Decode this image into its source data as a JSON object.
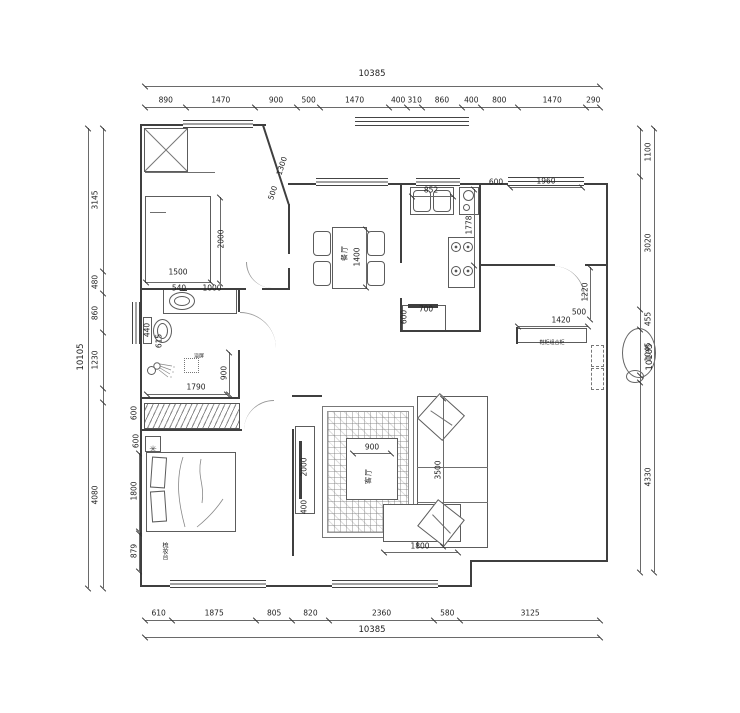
{
  "colors": {
    "wall": "#3f3f3f",
    "line": "#6a6a6a",
    "text": "#222222",
    "bg": "#ffffff"
  },
  "dims": {
    "top": {
      "total": "10385",
      "segments": [
        {
          "label": "890",
          "mm": 890
        },
        {
          "label": "1470",
          "mm": 1470
        },
        {
          "label": "900",
          "mm": 900
        },
        {
          "label": "500",
          "mm": 500
        },
        {
          "label": "1470",
          "mm": 1470
        },
        {
          "label": "400",
          "mm": 400
        },
        {
          "label": "310",
          "mm": 310
        },
        {
          "label": "860",
          "mm": 860
        },
        {
          "label": "400",
          "mm": 400
        },
        {
          "label": "800",
          "mm": 800
        },
        {
          "label": "1470",
          "mm": 1470
        },
        {
          "label": "290",
          "mm": 290
        }
      ]
    },
    "bottom": {
      "total": "10385",
      "segments": [
        {
          "label": "610",
          "mm": 610
        },
        {
          "label": "1875",
          "mm": 1875
        },
        {
          "label": "805",
          "mm": 805
        },
        {
          "label": "820",
          "mm": 820
        },
        {
          "label": "2360",
          "mm": 2360
        },
        {
          "label": "580",
          "mm": 580
        },
        {
          "label": "3125",
          "mm": 3125
        }
      ]
    },
    "left": {
      "total": "10105",
      "segments": [
        {
          "label": "3145",
          "mm": 3145
        },
        {
          "label": "480",
          "mm": 480
        },
        {
          "label": "860",
          "mm": 860
        },
        {
          "label": "1230",
          "mm": 1230
        },
        {
          "label": "",
          "mm": 310
        },
        {
          "label": "4080",
          "mm": 4080
        }
      ]
    },
    "right": {
      "total": "10105",
      "segments": [
        {
          "label": "1100",
          "mm": 1100
        },
        {
          "label": "3020",
          "mm": 3020
        },
        {
          "label": "455",
          "mm": 455
        },
        {
          "label": "1045",
          "mm": 1045
        },
        {
          "label": "",
          "mm": 155
        },
        {
          "label": "4330",
          "mm": 4330
        }
      ]
    }
  },
  "labels": {
    "dining": "餐厅",
    "living": "客厅",
    "shower_screen": "浴屏",
    "dresser": "梳妆台",
    "cabinet_note": "鞋柜组合柜"
  },
  "icons": {
    "planter": "✳"
  },
  "interior_dims": [
    {
      "label": "2000",
      "x": 221,
      "y": 239,
      "rot": -90,
      "line": {
        "x": 220,
        "y": 197,
        "w": 1,
        "h": 86
      }
    },
    {
      "label": "1500",
      "x": 178,
      "y": 272,
      "rot": 0,
      "line": {
        "x": 146,
        "y": 282,
        "w": 65,
        "h": 1
      }
    },
    {
      "label": "540",
      "x": 179,
      "y": 288,
      "rot": 0
    },
    {
      "label": "1000",
      "x": 212,
      "y": 288,
      "rot": 0
    },
    {
      "label": "1300",
      "x": 282,
      "y": 166,
      "rot": -72
    },
    {
      "label": "500",
      "x": 273,
      "y": 193,
      "rot": -72
    },
    {
      "label": "440",
      "x": 147,
      "y": 330,
      "rot": -90
    },
    {
      "label": "615",
      "x": 159,
      "y": 341,
      "rot": -90
    },
    {
      "label": "900",
      "x": 224,
      "y": 373,
      "rot": -90,
      "line": {
        "x": 229,
        "y": 352,
        "w": 1,
        "h": 42
      }
    },
    {
      "label": "1790",
      "x": 196,
      "y": 387,
      "rot": 0,
      "line": {
        "x": 147,
        "y": 394,
        "w": 80,
        "h": 1
      }
    },
    {
      "label": "600",
      "x": 134,
      "y": 413,
      "rot": -90
    },
    {
      "label": "600",
      "x": 136,
      "y": 441,
      "rot": -90
    },
    {
      "label": "1800",
      "x": 134,
      "y": 491,
      "rot": -90,
      "line": {
        "x": 139,
        "y": 453,
        "w": 1,
        "h": 78
      }
    },
    {
      "label": "879",
      "x": 134,
      "y": 551,
      "rot": -90,
      "line": {
        "x": 139,
        "y": 533,
        "w": 1,
        "h": 38
      }
    },
    {
      "label": "1400",
      "x": 357,
      "y": 257,
      "rot": -90,
      "line": {
        "x": 366,
        "y": 229,
        "w": 1,
        "h": 58
      }
    },
    {
      "label": "852",
      "x": 431,
      "y": 190,
      "rot": 0,
      "line": {
        "x": 412,
        "y": 196,
        "w": 41,
        "h": 1
      }
    },
    {
      "label": "1778",
      "x": 469,
      "y": 225,
      "rot": -90,
      "line": {
        "x": 474,
        "y": 189,
        "w": 1,
        "h": 76
      }
    },
    {
      "label": "600",
      "x": 404,
      "y": 317,
      "rot": -90
    },
    {
      "label": "700",
      "x": 426,
      "y": 309,
      "rot": 0
    },
    {
      "label": "600",
      "x": 496,
      "y": 182,
      "rot": 0
    },
    {
      "label": "1960",
      "x": 546,
      "y": 181,
      "rot": 0,
      "line": {
        "x": 510,
        "y": 187,
        "w": 72,
        "h": 1
      }
    },
    {
      "label": "1220",
      "x": 585,
      "y": 292,
      "rot": -90,
      "line": {
        "x": 590,
        "y": 267,
        "w": 1,
        "h": 52
      }
    },
    {
      "label": "500",
      "x": 579,
      "y": 312,
      "rot": 0
    },
    {
      "label": "1420",
      "x": 561,
      "y": 320,
      "rot": 0,
      "line": {
        "x": 518,
        "y": 326,
        "w": 70,
        "h": 1
      }
    },
    {
      "label": "900",
      "x": 372,
      "y": 447,
      "rot": 0,
      "line": {
        "x": 353,
        "y": 453,
        "w": 38,
        "h": 1
      }
    },
    {
      "label": "3500",
      "x": 438,
      "y": 470,
      "rot": -90,
      "line": {
        "x": 443,
        "y": 398,
        "w": 1,
        "h": 148
      }
    },
    {
      "label": "2000",
      "x": 304,
      "y": 467,
      "rot": -90
    },
    {
      "label": "400",
      "x": 304,
      "y": 507,
      "rot": -90
    },
    {
      "label": "1800",
      "x": 420,
      "y": 546,
      "rot": 0,
      "line": {
        "x": 384,
        "y": 552,
        "w": 74,
        "h": 1
      }
    }
  ]
}
